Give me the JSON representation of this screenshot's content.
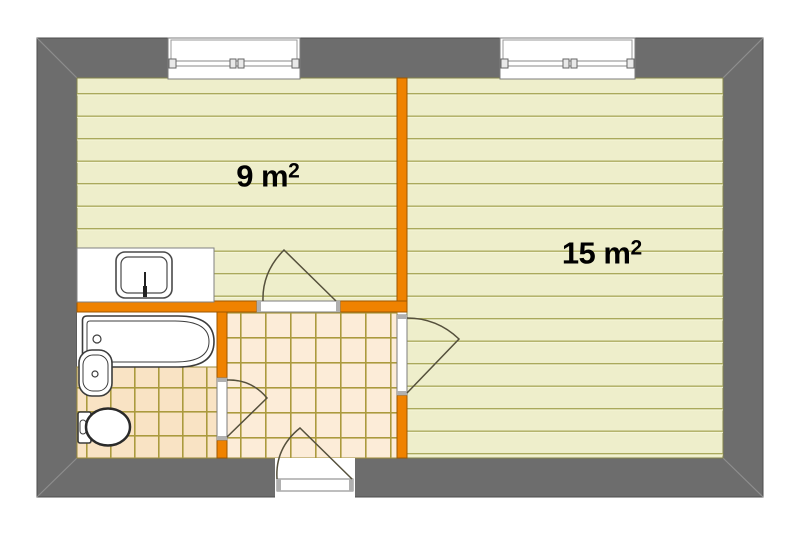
{
  "plan": {
    "type": "apartment-floor-plan",
    "labels": {
      "room9": {
        "base": "9 m",
        "sup": "2"
      },
      "room15": {
        "base": "15 m",
        "sup": "2"
      }
    },
    "rooms": [
      {
        "name": "room-9m2",
        "floor": "wood-planks"
      },
      {
        "name": "room-15m2",
        "floor": "wood-planks"
      },
      {
        "name": "hallway",
        "floor": "tiles"
      },
      {
        "name": "bathroom",
        "floor": "tiles"
      }
    ],
    "fixtures": [
      "window",
      "window",
      "kitchen-counter",
      "kitchen-sink",
      "bathtub",
      "washbasin",
      "toilet",
      "entrance-door",
      "room9-door",
      "room15-door",
      "bathroom-door"
    ],
    "colors": {
      "outer_wall": "#6d6d6d",
      "partition_wall": "#ef8200",
      "plank_floor": "#eeeecb",
      "plank_line": "#aaa95c",
      "bath_tile_bg": "#f9e3c4",
      "hall_tile_bg": "#fcecd8",
      "tile_line": "#ab9a3e",
      "fixture_outline": "#3c3c3c",
      "door_swing": "#55503c"
    }
  }
}
